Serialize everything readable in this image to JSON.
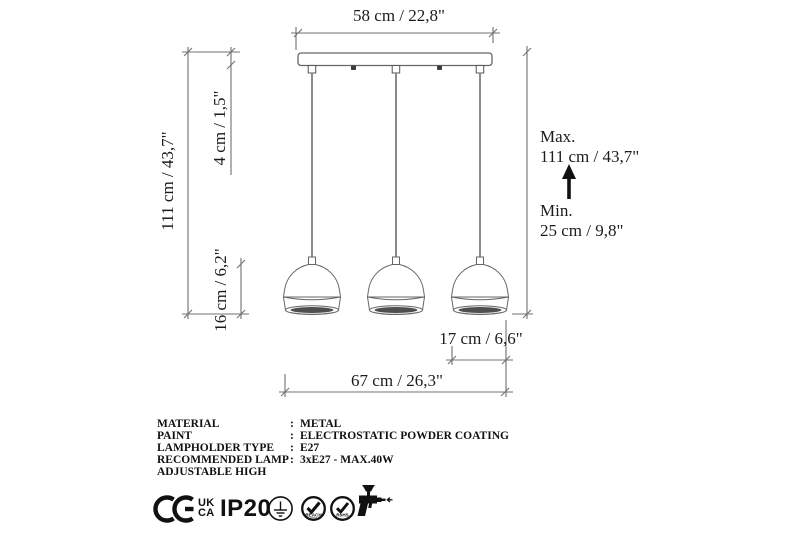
{
  "diagram": {
    "dimensions": {
      "rail_width": "58 cm / 22,8\"",
      "total_height": "111 cm / 43,7\"",
      "canopy_height": "4 cm / 1,5\"",
      "shade_height": "16 cm / 6,2\"",
      "shade_width": "17 cm / 6,6\"",
      "span_width": "67 cm / 26,3\"",
      "max_label": "Max.",
      "max_value": "111 cm / 43,7\"",
      "min_label": "Min.",
      "min_value": "25 cm / 9,8\""
    },
    "colors": {
      "line": "#707070",
      "shade_outline": "#666666",
      "cord": "#8a8a8a",
      "text": "#1c1c1c",
      "icon": "#111111"
    }
  },
  "specs": {
    "rows": [
      {
        "label": "MATERIAL",
        "colon": ":",
        "value": "METAL"
      },
      {
        "label": "PAINT",
        "colon": ":",
        "value": "ELECTROSTATIC POWDER COATING"
      },
      {
        "label": "LAMPHOLDER TYPE",
        "colon": ":",
        "value": "E27"
      },
      {
        "label": "RECOMMENDED LAMP",
        "colon": ":",
        "value": "3xE27 - MAX.40W"
      },
      {
        "label": "ADJUSTABLE HIGH",
        "colon": "",
        "value": ""
      }
    ]
  },
  "certifications": {
    "ce": {
      "icon": "ce-mark"
    },
    "ukca": {
      "line1": "UK",
      "line2": "CA"
    },
    "ip_rating": "IP20",
    "badges": [
      {
        "icon": "protective-earth-class1"
      },
      {
        "icon": "reach-check",
        "label": "REACH"
      },
      {
        "icon": "rohs-check",
        "label": "RoHS"
      },
      {
        "icon": "spray-gun"
      }
    ]
  }
}
